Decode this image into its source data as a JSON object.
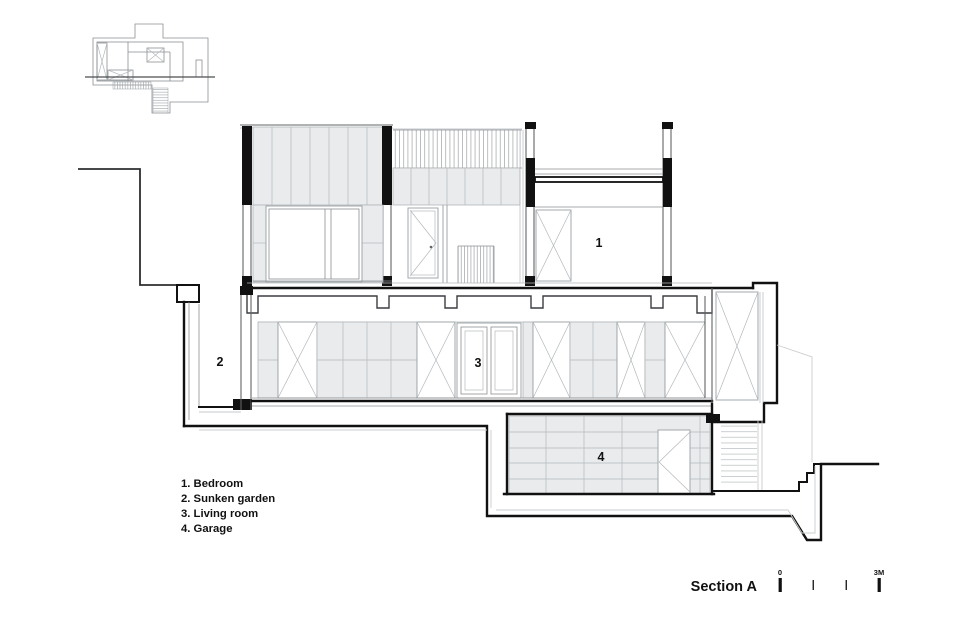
{
  "page": {
    "background": "#ffffff"
  },
  "drawing": {
    "type": "architectural-section",
    "title": "Section A",
    "rooms": [
      {
        "number": "1",
        "name": "Bedroom"
      },
      {
        "number": "2",
        "name": "Sunken garden"
      },
      {
        "number": "3",
        "name": "Living room"
      },
      {
        "number": "4",
        "name": "Garage"
      }
    ],
    "legend": {
      "items": [
        "1. Bedroom",
        "2. Sunken garden",
        "3. Living room",
        "4. Garage"
      ]
    },
    "scale_bar": {
      "zero_label": "0",
      "end_label": "3M"
    },
    "colors": {
      "cut_line": "#111111",
      "medium_line": "#606468",
      "light_line": "#b4b9bc",
      "panel_fill": "#e9ebed",
      "text": "#111111",
      "background": "#ffffff"
    }
  }
}
